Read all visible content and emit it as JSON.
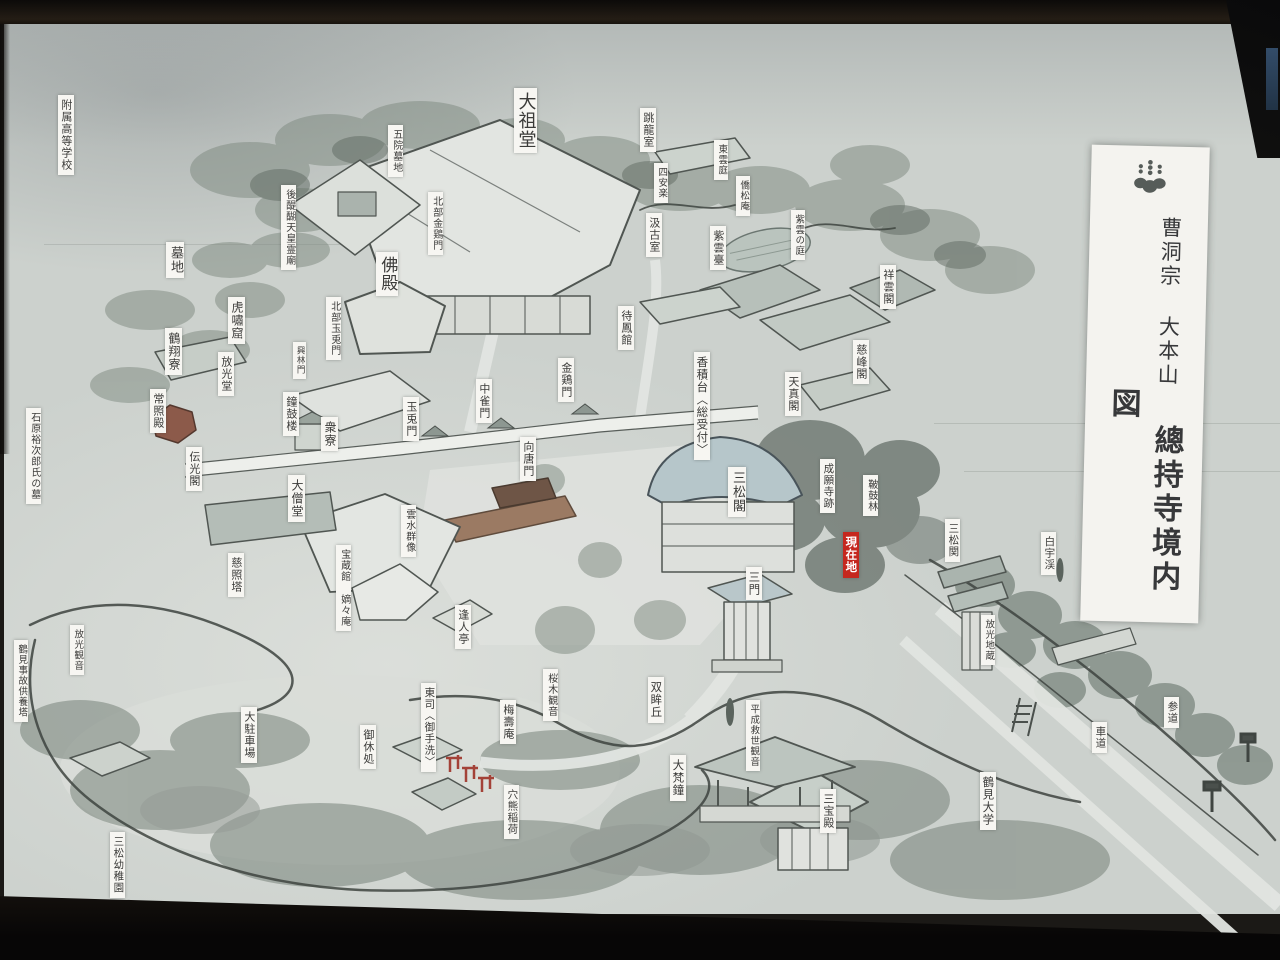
{
  "title_block": {
    "line1": "曹洞宗 大本山",
    "line2": "總持寺境内図",
    "crest": "paulownia-crest"
  },
  "colors": {
    "board_base": "#ccd1cd",
    "label_bg": "#f7f6f2",
    "label_ink": "#3b3b39",
    "marker_red": "#c5271e",
    "title_bg": "#f4f3ef",
    "frame_dark": "#12100d"
  },
  "current_location_text": "現在地",
  "map_labels": [
    {
      "id": "fuzoku-koko",
      "text": "附属高等学校",
      "x": 58,
      "y": 95,
      "size": 11
    },
    {
      "id": "goin-bochi",
      "text": "五院墓地",
      "x": 388,
      "y": 125,
      "size": 10
    },
    {
      "id": "godaigo-tenno-reibyo",
      "text": "後醍醐天皇霊廟",
      "x": 281,
      "y": 185,
      "size": 10
    },
    {
      "id": "bochi",
      "text": "墓地",
      "x": 166,
      "y": 242,
      "size": 13
    },
    {
      "id": "butsuden",
      "text": "佛殿",
      "x": 376,
      "y": 252,
      "size": 17
    },
    {
      "id": "kosho-kutsu",
      "text": "虎嘯窟",
      "x": 228,
      "y": 297,
      "size": 12
    },
    {
      "id": "kakusho-ryo",
      "text": "鶴翔寮",
      "x": 165,
      "y": 328,
      "size": 12
    },
    {
      "id": "hokubu-kinkeimon",
      "text": "北部金鶏門",
      "x": 428,
      "y": 192,
      "size": 10
    },
    {
      "id": "daisodo",
      "text": "大祖堂",
      "x": 514,
      "y": 88,
      "size": 18
    },
    {
      "id": "choryu-shitsu",
      "text": "跳龍室",
      "x": 640,
      "y": 108,
      "size": 11
    },
    {
      "id": "shinonome-tei",
      "text": "東雲庭",
      "x": 714,
      "y": 140,
      "size": 9.5
    },
    {
      "id": "shianraku",
      "text": "四安楽",
      "x": 654,
      "y": 163,
      "size": 9.5
    },
    {
      "id": "kyosho-an",
      "text": "僑松庵",
      "x": 736,
      "y": 176,
      "size": 9.5
    },
    {
      "id": "kyuko-shitsu",
      "text": "汲古室",
      "x": 646,
      "y": 213,
      "size": 11
    },
    {
      "id": "shiundai",
      "text": "紫雲臺",
      "x": 710,
      "y": 226,
      "size": 11
    },
    {
      "id": "shiun-no-niwa",
      "text": "紫雲の庭",
      "x": 791,
      "y": 210,
      "size": 9.5
    },
    {
      "id": "shoun-kaku",
      "text": "祥雲閣",
      "x": 880,
      "y": 265,
      "size": 11
    },
    {
      "id": "jiho-kaku",
      "text": "慈峰閣",
      "x": 853,
      "y": 340,
      "size": 11
    },
    {
      "id": "taiho-kan",
      "text": "待鳳館",
      "x": 618,
      "y": 306,
      "size": 11
    },
    {
      "id": "tenshin-kaku",
      "text": "天真閣",
      "x": 785,
      "y": 372,
      "size": 11
    },
    {
      "id": "koshakudai-uketsuke",
      "text": "香積台〈総受付〉",
      "x": 694,
      "y": 352,
      "size": 11.5
    },
    {
      "id": "kinkei-mon",
      "text": "金鶏門",
      "x": 558,
      "y": 358,
      "size": 11
    },
    {
      "id": "chujaku-mon",
      "text": "中雀門",
      "x": 476,
      "y": 379,
      "size": 11
    },
    {
      "id": "gyokuto-mon",
      "text": "玉兎門",
      "x": 403,
      "y": 397,
      "size": 11
    },
    {
      "id": "shuryo",
      "text": "衆寮",
      "x": 321,
      "y": 417,
      "size": 12
    },
    {
      "id": "shoko-ro",
      "text": "鐘鼓楼",
      "x": 283,
      "y": 392,
      "size": 11
    },
    {
      "id": "hoko-do",
      "text": "放光堂",
      "x": 218,
      "y": 352,
      "size": 11
    },
    {
      "id": "josho-den",
      "text": "常照殿",
      "x": 150,
      "y": 389,
      "size": 11
    },
    {
      "id": "denko-kaku",
      "text": "伝光閣",
      "x": 186,
      "y": 447,
      "size": 11
    },
    {
      "id": "hokubu-gyokuto-mon",
      "text": "北部玉兎門",
      "x": 326,
      "y": 297,
      "size": 10
    },
    {
      "id": "korin-mon",
      "text": "興林門",
      "x": 293,
      "y": 342,
      "size": 8.5
    },
    {
      "id": "daiso-do",
      "text": "大僧堂",
      "x": 288,
      "y": 475,
      "size": 12
    },
    {
      "id": "unsui-gunzo",
      "text": "雲水群像",
      "x": 401,
      "y": 505,
      "size": 10
    },
    {
      "id": "hozokan-chakuchakuan",
      "text": "宝蔵館 嫡々庵",
      "x": 336,
      "y": 545,
      "size": 10
    },
    {
      "id": "mukara-mon",
      "text": "向唐門",
      "x": 520,
      "y": 437,
      "size": 11
    },
    {
      "id": "jisho-to",
      "text": "慈照塔",
      "x": 228,
      "y": 553,
      "size": 11
    },
    {
      "id": "ishihara-yujiro-haka",
      "text": "石原裕次郎氏の墓",
      "x": 26,
      "y": 408,
      "size": 10
    },
    {
      "id": "sansho-kaku",
      "text": "三松閣",
      "x": 728,
      "y": 467,
      "size": 13
    },
    {
      "id": "joganji-ato",
      "text": "成願寺跡",
      "x": 820,
      "y": 459,
      "size": 10.5
    },
    {
      "id": "genzaichi",
      "text": "現在地",
      "x": 843,
      "y": 532,
      "size": 11.5,
      "style": "red"
    },
    {
      "id": "hiko-rin",
      "text": "鞁鼓林",
      "x": 863,
      "y": 475,
      "size": 10
    },
    {
      "id": "sansho-seki",
      "text": "三松関",
      "x": 945,
      "y": 519,
      "size": 10.5
    },
    {
      "id": "hakuu-kei",
      "text": "白宇渓",
      "x": 1041,
      "y": 532,
      "size": 10.5
    },
    {
      "id": "hoko-jizo",
      "text": "放光地蔵",
      "x": 981,
      "y": 615,
      "size": 9.5
    },
    {
      "id": "san-mon",
      "text": "三門",
      "x": 746,
      "y": 567,
      "size": 11.5
    },
    {
      "id": "hojin-tei",
      "text": "逢人亭",
      "x": 455,
      "y": 605,
      "size": 11
    },
    {
      "id": "tosu-otearai",
      "text": "東司〈御手洗〉",
      "x": 421,
      "y": 683,
      "size": 10.5
    },
    {
      "id": "sakuragi-kannon",
      "text": "桜木観音",
      "x": 543,
      "y": 669,
      "size": 10
    },
    {
      "id": "baiju-an",
      "text": "梅壽庵",
      "x": 500,
      "y": 700,
      "size": 11
    },
    {
      "id": "sobo-kyu",
      "text": "双眸丘",
      "x": 648,
      "y": 677,
      "size": 11.5
    },
    {
      "id": "daibon-sho",
      "text": "大梵鐘",
      "x": 670,
      "y": 755,
      "size": 11.5
    },
    {
      "id": "anaguma-inari",
      "text": "穴熊稲荷",
      "x": 504,
      "y": 785,
      "size": 10.5
    },
    {
      "id": "heisei-guze-kannon",
      "text": "平成救世観音",
      "x": 746,
      "y": 700,
      "size": 9.5
    },
    {
      "id": "sanbo-den",
      "text": "三宝殿",
      "x": 820,
      "y": 789,
      "size": 11
    },
    {
      "id": "tsurumi-daigaku",
      "text": "鶴見大学",
      "x": 980,
      "y": 772,
      "size": 11.5
    },
    {
      "id": "shado",
      "text": "車道",
      "x": 1092,
      "y": 722,
      "size": 10.5
    },
    {
      "id": "sando",
      "text": "参道",
      "x": 1164,
      "y": 697,
      "size": 10.5
    },
    {
      "id": "oyasumi-dokoro",
      "text": "御休処",
      "x": 360,
      "y": 725,
      "size": 11
    },
    {
      "id": "dai-chushajo",
      "text": "大駐車場",
      "x": 241,
      "y": 707,
      "size": 11
    },
    {
      "id": "sansho-yochien",
      "text": "三松幼稚園",
      "x": 110,
      "y": 832,
      "size": 10.5
    },
    {
      "id": "tsurumi-jiko-kuyoto",
      "text": "鶴見事故供養塔",
      "x": 14,
      "y": 640,
      "size": 9.5
    },
    {
      "id": "hoko-kannon",
      "text": "放光観音",
      "x": 70,
      "y": 625,
      "size": 9.5
    }
  ]
}
